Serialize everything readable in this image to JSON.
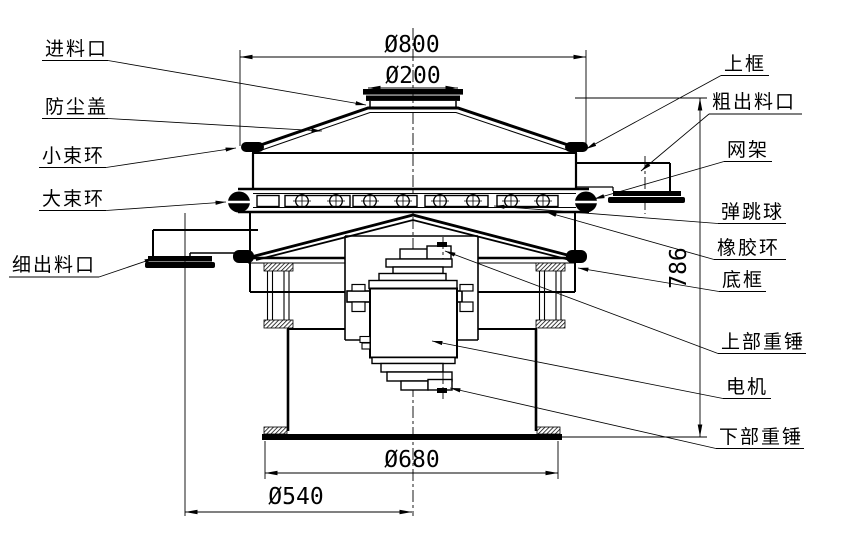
{
  "drawing": {
    "background": "#ffffff",
    "line_color": "#000000",
    "labels_left": [
      {
        "text": "进料口"
      },
      {
        "text": "防尘盖"
      },
      {
        "text": "小束环"
      },
      {
        "text": "大束环"
      },
      {
        "text": "细出料口"
      }
    ],
    "labels_right": [
      {
        "text": "上框"
      },
      {
        "text": "粗出料口"
      },
      {
        "text": "网架"
      },
      {
        "text": "弹跳球"
      },
      {
        "text": "橡胶环"
      },
      {
        "text": "底框"
      },
      {
        "text": "上部重锤"
      },
      {
        "text": "电机"
      },
      {
        "text": "下部重锤"
      }
    ],
    "dimensions": [
      {
        "text": "Ø800"
      },
      {
        "text": "Ø200"
      },
      {
        "text": "786"
      },
      {
        "text": "Ø680"
      },
      {
        "text": "Ø540"
      }
    ]
  }
}
